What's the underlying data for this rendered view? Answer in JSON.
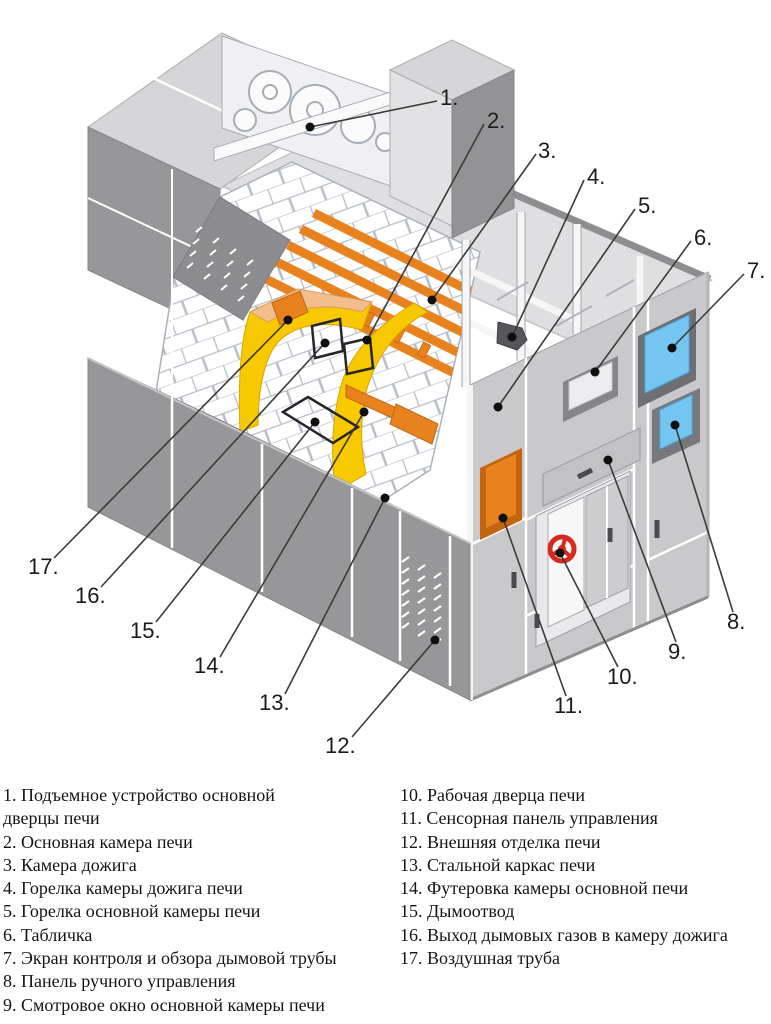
{
  "figure": {
    "kind": "isometric cutaway technical illustration",
    "subject": "Промышленная печь (разрез) с пронумерованными элементами конструкции",
    "callout_count": 17
  },
  "legend": {
    "column1": [
      {
        "num": "1.",
        "label": "Подъемное устройство основной дверцы печи"
      },
      {
        "num": "2.",
        "label": "Основная камера печи"
      },
      {
        "num": "3.",
        "label": "Камера дожига"
      },
      {
        "num": "4.",
        "label": "Горелка камеры дожига печи"
      },
      {
        "num": "5.",
        "label": "Горелка основной камеры печи"
      },
      {
        "num": "6.",
        "label": "Табличка"
      },
      {
        "num": "7.",
        "label": "Экран контроля и обзора дымовой трубы"
      },
      {
        "num": "8.",
        "label": "Панель ручного управления"
      },
      {
        "num": "9.",
        "label": "Смотровое окно основной камеры печи"
      }
    ],
    "column2": [
      {
        "num": "10.",
        "label": "Рабочая дверца печи"
      },
      {
        "num": "11.",
        "label": "Сенсорная панель управления"
      },
      {
        "num": "12.",
        "label": "Внешняя отделка печи"
      },
      {
        "num": "13.",
        "label": "Стальной каркас печи"
      },
      {
        "num": "14.",
        "label": "Футеровка камеры основной печи"
      },
      {
        "num": "15.",
        "label": "Дымоотвод"
      },
      {
        "num": "16.",
        "label": "Выход дымовых газов в камеру дожига"
      },
      {
        "num": "17.",
        "label": "Воздушная труба"
      }
    ]
  },
  "colors": {
    "panel_dark": "#97979A",
    "panel_light": "#DFDFE1",
    "tube_orange": "#E8821E",
    "lining_yellow": "#F8C800",
    "lining_peach": "#F2BE8E",
    "screen_blue": "#74C6F0",
    "handwheel_red": "#D52B1E",
    "callout_line": "#3B3B3B"
  }
}
